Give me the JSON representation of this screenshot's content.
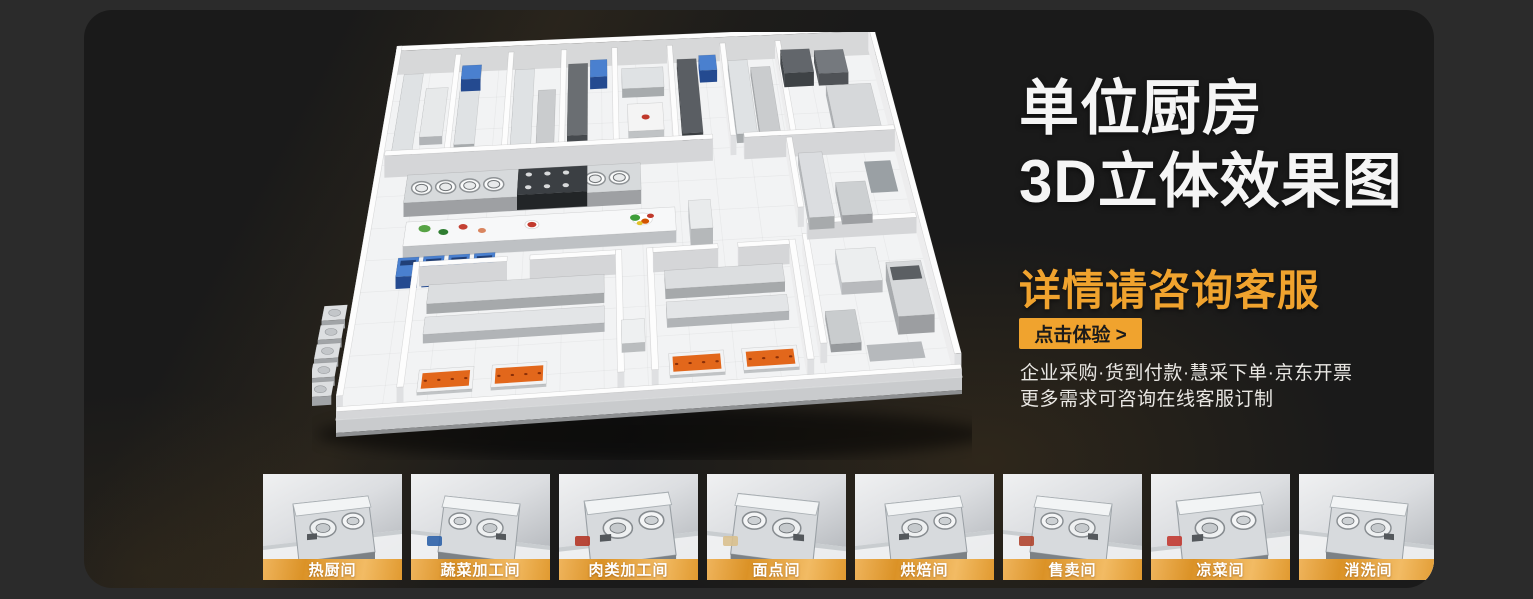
{
  "banner": {
    "title_line1": "单位厨房",
    "title_line2": "3D立体效果图",
    "subtitle": "详情请咨询客服",
    "cta_button": "点击体验 >",
    "info_line1": "企业采购·货到付款·慧采下单·京东开票",
    "info_line2": "更多需求可咨询在线客服订制"
  },
  "thumbnails": [
    {
      "label": "热厨间"
    },
    {
      "label": "蔬菜加工间"
    },
    {
      "label": "肉类加工间"
    },
    {
      "label": "面点间"
    },
    {
      "label": "烘焙间"
    },
    {
      "label": "售卖间"
    },
    {
      "label": "凉菜间"
    },
    {
      "label": "消洗间"
    }
  ],
  "colors": {
    "accent_orange": "#F0A32E",
    "panel_background": "#1A1A1A",
    "outer_background": "#2B2B2B",
    "title_text": "#F5F5F5",
    "cta_text": "#1B1B1B",
    "thumb_label_orange_dark": "#DB9226",
    "thumb_label_orange_light": "#F2BB64",
    "floorplan_tray_orange": "#E2671B",
    "floorplan_machine_blue": "#4A80CF"
  }
}
